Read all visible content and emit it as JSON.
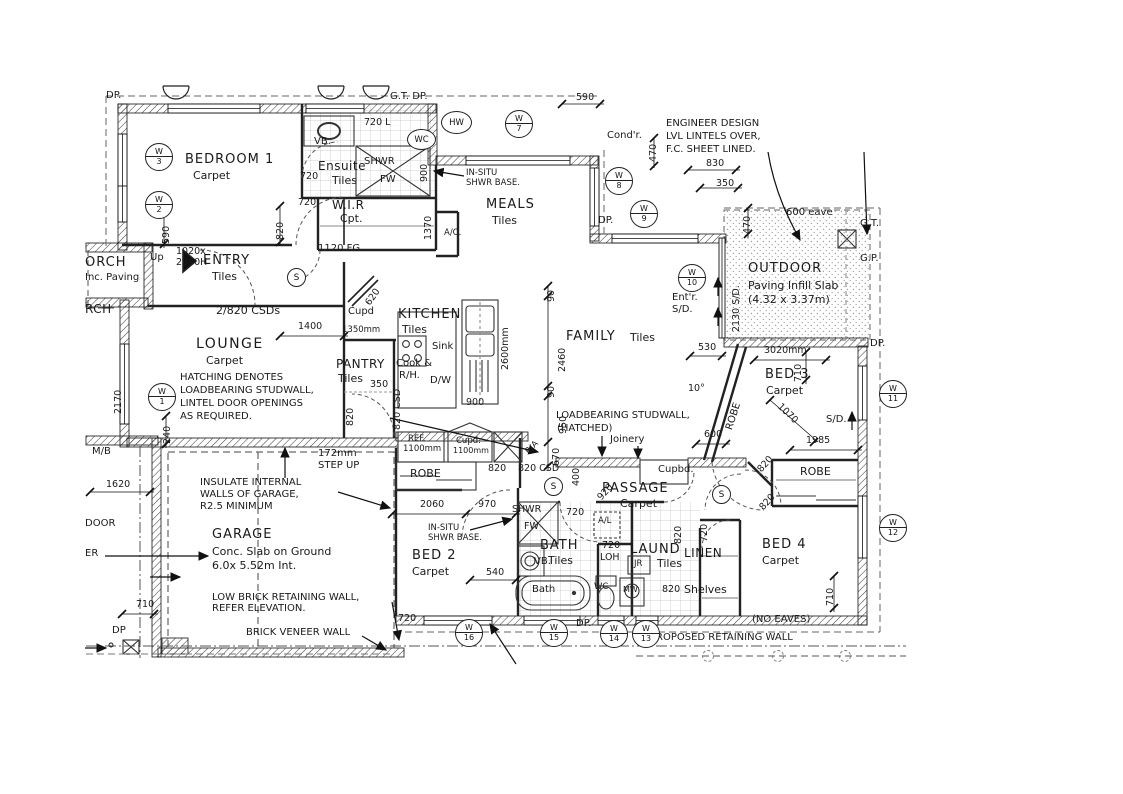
{
  "rooms": {
    "bedroom1": {
      "name": "BEDROOM 1",
      "floor": "Carpet"
    },
    "ensuite": {
      "name": "Ensuite",
      "floor": "Tiles"
    },
    "wir": {
      "name": "W.I.R",
      "floor": "Cpt."
    },
    "meals": {
      "name": "MEALS",
      "floor": "Tiles"
    },
    "entry": {
      "name": "ENTRY",
      "floor": "Tiles"
    },
    "porch": {
      "name": "ORCH",
      "floor": "Inc. Paving",
      "name2": "RCH"
    },
    "lounge": {
      "name": "LOUNGE",
      "floor": "Carpet"
    },
    "pantry": {
      "name": "PANTRY",
      "floor": "Tiles"
    },
    "kitchen": {
      "name": "KITCHEN",
      "floor": "Tiles"
    },
    "family": {
      "name": "FAMILY",
      "floor": "Tiles"
    },
    "garage": {
      "name": "GARAGE",
      "note1": "Conc. Slab on Ground",
      "note2": "6.0x 5.52m Int."
    },
    "outdoor": {
      "name": "OUTDOOR",
      "note1": "Paving Infill Slab",
      "note2": "(4.32 x 3.37m)"
    },
    "bed2": {
      "name": "BED 2",
      "floor": "Carpet"
    },
    "bed3": {
      "name": "BED 3",
      "floor": "Carpet"
    },
    "bed4": {
      "name": "BED 4",
      "floor": "Carpet"
    },
    "bath": {
      "name": "BATH",
      "floor": "Tiles"
    },
    "laund": {
      "name": "LAUND",
      "floor": "Tiles"
    },
    "linen": {
      "name": "LINEN",
      "note": "Shelves"
    },
    "passage": {
      "name": "PASSAGE",
      "floor": "Carpet"
    }
  },
  "notes": {
    "engineer1": "ENGINEER DESIGN",
    "engineer2": "LVL LINTELS OVER,",
    "engineer3": "F.C. SHEET LINED.",
    "timber1": "100mm SQ. TIMBER",
    "timber2": "ON GALV. STIRRUPS",
    "timber3": "470mm SQ. BRICK",
    "hatching1": "HATCHING DENOTES",
    "hatching2": "LOADBEARING STUDWALL,",
    "hatching3": "LINTEL DOOR OPENINGS",
    "hatching4": "AS REQUIRED.",
    "loadbearing1": "LOADBEARING STUDWALL,",
    "loadbearing2": "(HATCHED)",
    "joinery": "Joinery",
    "insulate1": "INSULATE INTERNAL",
    "insulate2": "WALLS OF GARAGE,",
    "insulate3": "R2.5 MINIMUM",
    "step1": "172mm",
    "step2": "STEP UP",
    "lowbrick1": "LOW BRICK RETAINING WALL,",
    "lowbrick2": "REFER ELEVATION.",
    "brickveneer": "BRICK VENEER WALL",
    "retaining": "PROPOSED RETAINING WALL",
    "noeaves": "(NO EAVES)",
    "csds": "2/820 CSDs",
    "fg": "1120 FG",
    "door1020a": "1020x",
    "door1020b": "2340H",
    "up": "Up",
    "eave": "600 eave",
    "insitu1": "IN-SITU",
    "insitu2": "SHWR BASE."
  },
  "fixtures": {
    "vb": "VB.",
    "shwr": "SHWR",
    "fw": "FW",
    "wc": "WC",
    "hw": "HW",
    "sink": "Sink",
    "cook1": "Cook &",
    "cook2": "R/H.",
    "dw": "D/W",
    "bathtub": "Bath",
    "ref1": "REF.",
    "ref2": "1100mm",
    "cupd1": "Cupd.",
    "cupd2": "1100mm",
    "cupd": "Cupd",
    "cupbd": "Cupbd.",
    "robe": "ROBE",
    "jr": "JR",
    "mw": "MW",
    "ac": "A/C.",
    "al": "A/L",
    "ra": "R/A",
    "l720": "720 L",
    "loh1": "720",
    "loh2": "LOH"
  },
  "markers": {
    "dp": "DP.",
    "dp_plain": "DP",
    "gt": "G.T.",
    "gtdp": "G.T.  DP.",
    "gp": "G.P.",
    "condr": "Cond'r.",
    "entr1": "Ent'r.",
    "entr2": "S/D.",
    "sd": "S/D.",
    "sd2130": "2130 S/D.",
    "mb": "M/B",
    "s": "S",
    "door": "DOOR",
    "er": "ER"
  },
  "dims": {
    "d590top": "590",
    "d470m": "470",
    "d830": "830",
    "d350m": "350",
    "d590b": "590",
    "d820b": "820",
    "d720ens": "720",
    "d720wir": "720",
    "d900ens": "900",
    "d1370": "1370",
    "d2170": "2170",
    "d240": "240",
    "d1400": "1400",
    "d620": "620",
    "d1350": "1350mm",
    "d350p": "350",
    "d820p": "820",
    "d820csdk": "820 CSD",
    "d2600": "2600mm",
    "d900k": "900",
    "d90a": "90",
    "d2460": "2460",
    "d90b": "90",
    "d950": "950",
    "d670": "670",
    "d400": "400",
    "d920": "920",
    "d820r": "820",
    "d820csdr": "820 CSD",
    "d2060": "2060",
    "d970": "970",
    "d540": "540",
    "d720ba": "720",
    "d820l": "820",
    "d820lt": "820",
    "d720li": "720",
    "d820b4a": "820",
    "d820b4b": "820",
    "d600": "600",
    "d530": "530",
    "d3020": "3020mm",
    "d710b3": "710",
    "d1070": "1070",
    "d1985": "1985",
    "d710b4": "710",
    "d710g": "710",
    "d1620": "1620",
    "d470o": "470",
    "d720g": "720",
    "d10": "10°"
  },
  "windows": {
    "w1": {
      "l": "W",
      "n": "1"
    },
    "w2": {
      "l": "W",
      "n": "2"
    },
    "w3": {
      "l": "W",
      "n": "3"
    },
    "w7": {
      "l": "W",
      "n": "7"
    },
    "w8": {
      "l": "W",
      "n": "8"
    },
    "w9": {
      "l": "W",
      "n": "9"
    },
    "w10": {
      "l": "W",
      "n": "10"
    },
    "w11": {
      "l": "W",
      "n": "11"
    },
    "w12": {
      "l": "W",
      "n": "12"
    },
    "w13": {
      "l": "W",
      "n": "13"
    },
    "w14": {
      "l": "W",
      "n": "14"
    },
    "w15": {
      "l": "W",
      "n": "15"
    },
    "w16": {
      "l": "W",
      "n": "16"
    }
  }
}
